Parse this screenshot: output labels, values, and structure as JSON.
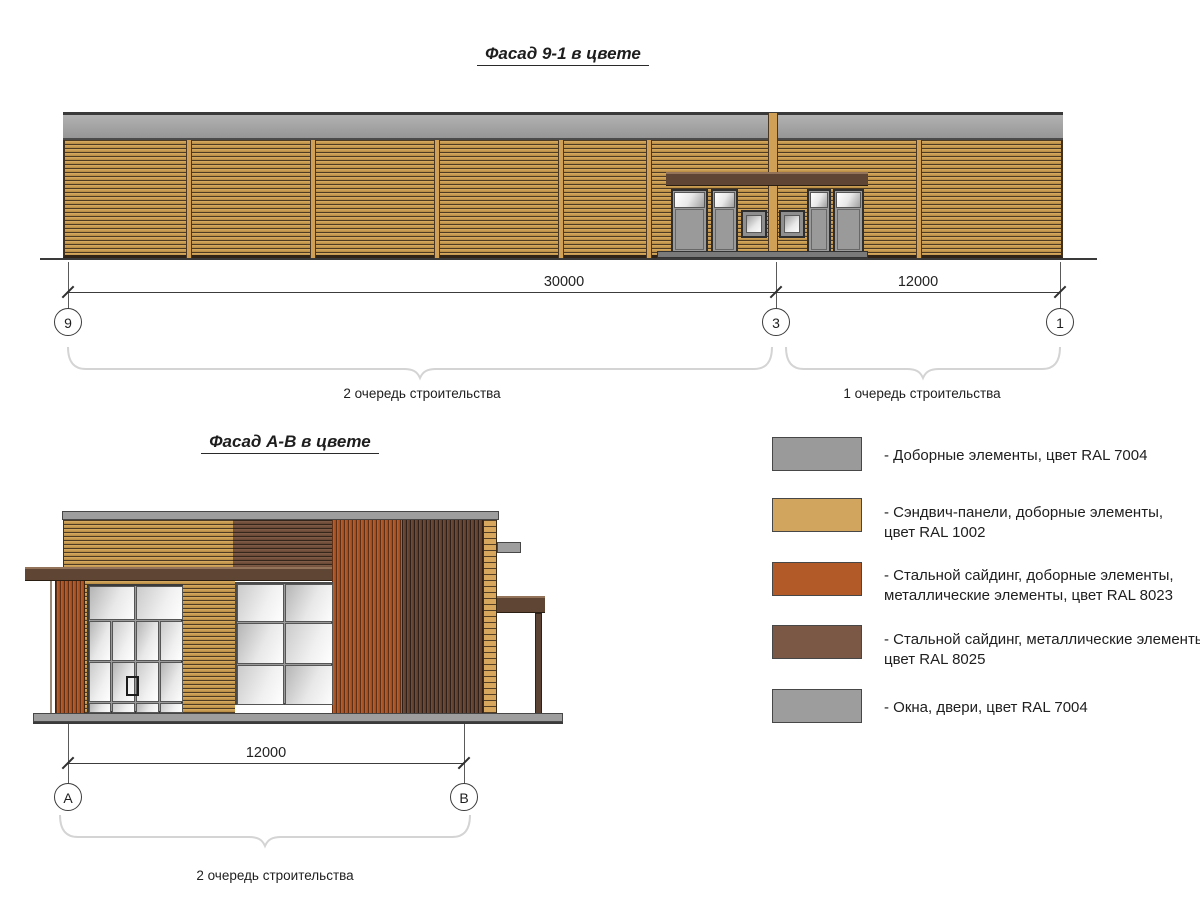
{
  "facade_top": {
    "title": "Фасад 9-1 в цвете",
    "dim_left": "30000",
    "dim_right": "12000",
    "axis_left": "9",
    "axis_mid": "3",
    "axis_right": "1",
    "phase_left": "2 очередь строительства",
    "phase_right": "1 очередь строительства"
  },
  "facade_bottom": {
    "title": "Фасад А-В в цвете",
    "dim": "12000",
    "axis_left": "А",
    "axis_right": "В",
    "phase": "2 очередь строительства"
  },
  "legend": {
    "items": [
      {
        "color": "#9a9a9a",
        "lines": [
          "- Доборные элементы, цвет RAL 7004"
        ]
      },
      {
        "color": "#d2a55e",
        "lines": [
          "- Сэндвич-панели, доборные элементы,",
          "цвет RAL 1002"
        ]
      },
      {
        "color": "#b25a28",
        "lines": [
          "- Стальной сайдинг, доборные элементы,",
          "металлические элементы, цвет RAL 8023"
        ]
      },
      {
        "color": "#7b5845",
        "lines": [
          "- Стальной сайдинг, металлические элементы,",
          "цвет RAL 8025"
        ]
      },
      {
        "color": "#9d9d9d",
        "lines": [
          "- Окна, двери, цвет RAL 7004"
        ]
      }
    ]
  },
  "palette": {
    "ral_7004_gray": "#9e9e9e",
    "ral_1002_tan": "#cfa055",
    "ral_8023_orange": "#b25a28",
    "ral_8025_brown": "#6f4c38"
  }
}
